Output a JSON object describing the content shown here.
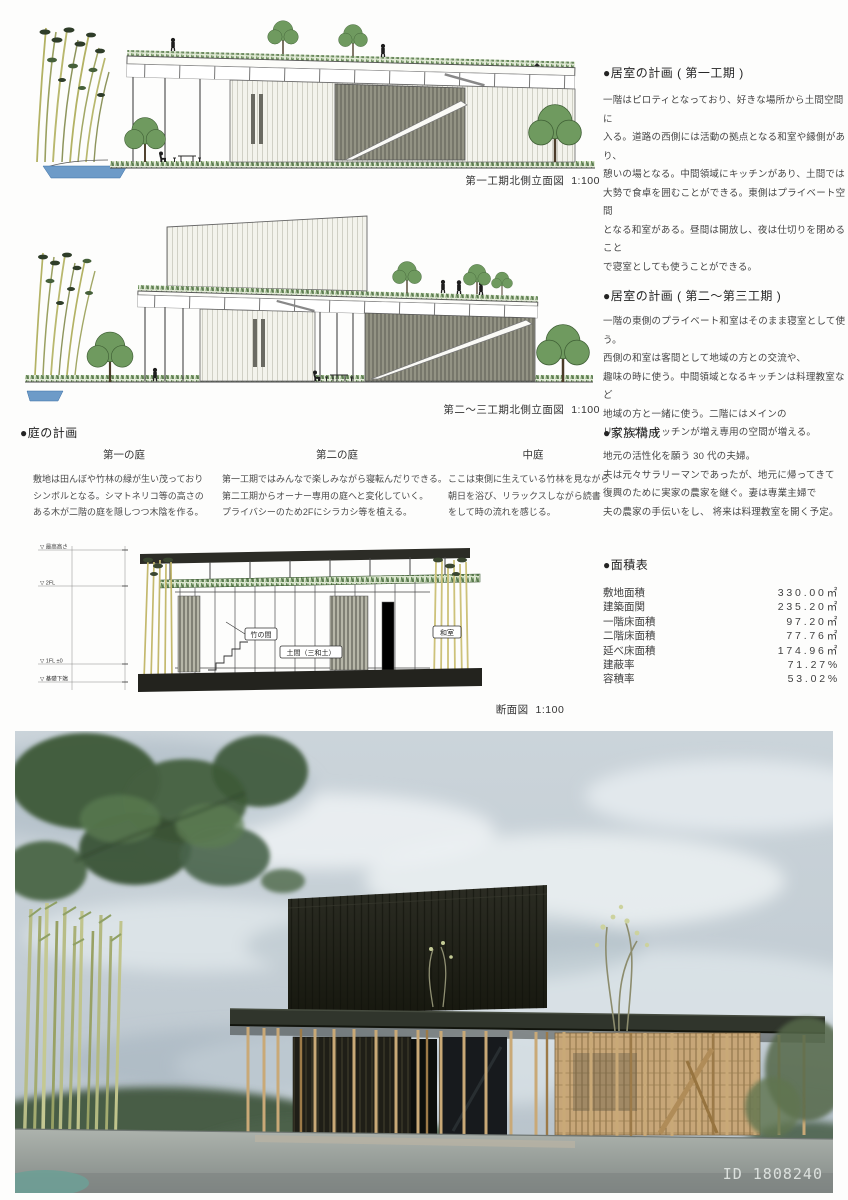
{
  "sections": {
    "plan1": {
      "heading": "●居室の計画 ( 第一工期 )",
      "body": "一階はピロティとなっており、好きな場所から土間空間に\n入る。道路の西側には活動の拠点となる和室や縁側があり、\n憩いの場となる。中間領域にキッチンがあり、土間では\n大勢で食卓を囲むことができる。東側はプライベート空間\nとなる和室がある。昼間は開放し、夜は仕切りを閉めること\nで寝室としても使うことができる。",
      "caption": "第一工期北側立面図  1:100"
    },
    "plan2": {
      "heading": "●居室の計画 ( 第二〜第三工期 )",
      "body": "一階の東側のプライベート和室はそのまま寝室として使う。\n西側の和室は客間として地域の方との交流や、\n趣味の時に使う。中間領域となるキッチンは料理教室など\n地域の方と一緒に使う。二階にはメインの\nリビング・キッチンが増え専用の空間が増える。",
      "caption": "第二〜三工期北側立面図  1:100"
    },
    "garden": {
      "heading": "●庭の計画",
      "columns": [
        {
          "title": "第一の庭",
          "body": "敷地は田んぼや竹林の緑が生い茂っており\nシンボルとなる。シマトネリコ等の高さの\nある木が二階の庭を隠しつつ木陰を作る。"
        },
        {
          "title": "第二の庭",
          "body": "第一工期ではみんなで楽しみながら寝転んだりできる。\n第二工期からオーナー専用の庭へと変化していく。\nプライバシーのため2Fにシラカシ等を植える。"
        },
        {
          "title": "中庭",
          "body": "ここは東側に生えている竹林を見ながら\n朝日を浴び、リラックスしながら読書\nをして時の流れを感じる。"
        }
      ]
    },
    "family": {
      "heading": "●家族構成",
      "body": "地元の活性化を願う 30 代の夫婦。\n夫は元々サラリーマンであったが、地元に帰ってきて\n復興のために実家の農家を継ぐ。妻は専業主婦で\n夫の農家の手伝いをし、 将来は料理教室を開く予定。"
    },
    "area": {
      "heading": "●面積表",
      "rows": [
        {
          "label": "敷地面積",
          "value": "330.00㎡"
        },
        {
          "label": "建築面関",
          "value": "235.20㎡"
        },
        {
          "label": "一階床面積",
          "value": "97.20㎡"
        },
        {
          "label": "二階床面積",
          "value": "77.76㎡"
        },
        {
          "label": "延べ床面積",
          "value": "174.96㎡"
        },
        {
          "label": "建蔽率",
          "value": "71.27%"
        },
        {
          "label": "容積率",
          "value": "53.02%"
        }
      ]
    },
    "section_drawing": {
      "caption": "断面図  1:100",
      "labels": {
        "bamboo_room": "竹の間",
        "doma": "土間（三和土）",
        "washitsu": "和室"
      },
      "levels": [
        "▽ 最高高さ",
        "▽ 2FL",
        "▽ 1FL ±0",
        "▽ 基礎下端"
      ]
    },
    "render": {
      "watermark": "ID 1808240"
    },
    "colors": {
      "ink": "#3a3a3a",
      "grass": "#567f44",
      "water": "#6d9bc8",
      "wood": "#c9a977",
      "dark_building": "#1e1d16"
    }
  }
}
